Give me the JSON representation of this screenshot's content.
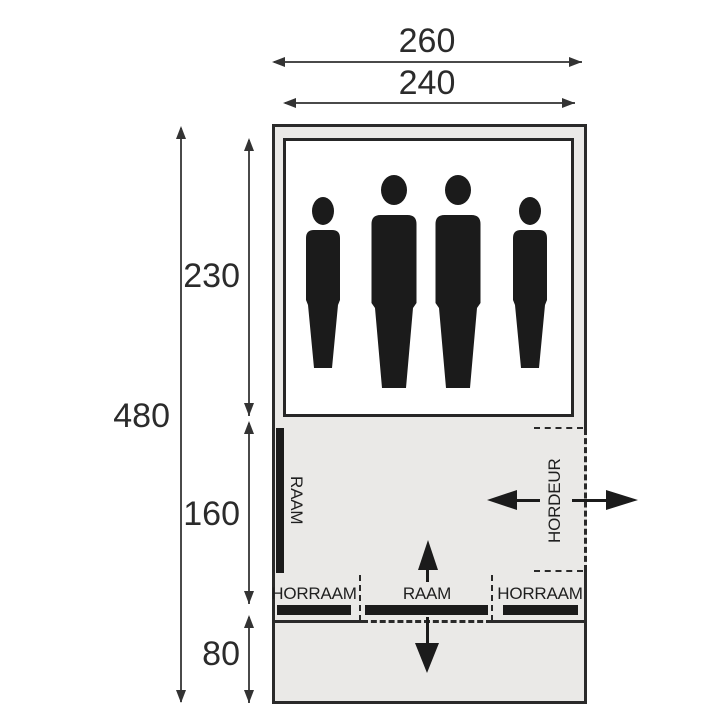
{
  "diagram": {
    "kind": "tent-floorplan",
    "dimensions": {
      "outer_width": "260",
      "inner_width": "240",
      "total_length": "480",
      "sleeping_length": "230",
      "living_length": "160",
      "canopy_length": "80"
    },
    "labels": {
      "side_window": "RAAM",
      "screen_door": "HORDEUR",
      "front_left_window": "HORRAAM",
      "front_center_window": "RAAM",
      "front_right_window": "HORRAAM"
    },
    "people": [
      "small",
      "large",
      "large",
      "small"
    ],
    "colors": {
      "background": "#ffffff",
      "tent_fill": "#eae9e7",
      "outline": "#2a2a2a",
      "solid_black": "#1b1b1b",
      "dimension_line": "#4a4a4a",
      "text": "#2b2b2b"
    }
  }
}
